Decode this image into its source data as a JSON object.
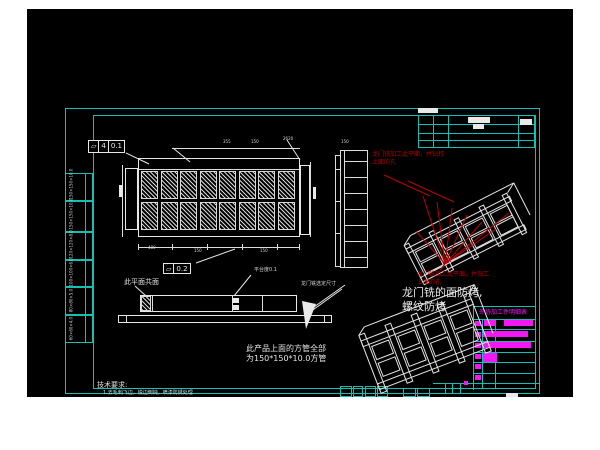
{
  "colors": {
    "bg": "#ffffff",
    "viewport": "#000000",
    "frame": "#14c0b4",
    "line": "#e9e9e9",
    "red": "#b40000",
    "magenta": "#f318f3"
  },
  "notes": {
    "red_top_1": "龙门铣加工此平面，并钻打",
    "red_top_2": "上面的孔",
    "red_bottom_1": "龙门铣加工此平面，并加工",
    "red_bottom_2": "上面的孔",
    "bake_1": "龙门铣的面防烤,",
    "bake_2": "螺纹防烤",
    "tube_1": "此产品上面的方管全部",
    "tube_2": "为150*150*10.0方管",
    "coplanar": "此平面共面",
    "platform": "平台度0.1",
    "gantry_dim": "龙门铣选定尺寸",
    "tech_title": "技术要求:",
    "tech_item": "1.去毛刺飞边，锐边倒钝，喷漆防锈处理"
  },
  "fcf1": {
    "sym": "▱",
    "n": "4",
    "val": "0.1"
  },
  "fcf2": {
    "sym": "▱",
    "val": "0.2"
  },
  "bom": {
    "header": "外协加工件明细表",
    "origin": [
      446,
      297
    ],
    "rows": [
      [
        [
          2,
          15,
          6,
          5
        ],
        [
          11,
          14,
          12,
          6
        ],
        [
          31,
          14,
          29,
          6
        ]
      ],
      [
        [
          2,
          26,
          6,
          5
        ],
        [
          10,
          25,
          45,
          6
        ]
      ],
      [
        [
          2,
          37,
          6,
          5
        ],
        [
          10,
          36,
          48,
          6
        ]
      ],
      [
        [
          2,
          48,
          6,
          5
        ],
        [
          10,
          47,
          14,
          9
        ]
      ],
      [
        [
          2,
          58,
          6,
          5
        ]
      ],
      [
        [
          2,
          69,
          6,
          5
        ]
      ]
    ]
  },
  "left_strip": {
    "ys": [
      164,
      192,
      223,
      251,
      278,
      306,
      334
    ],
    "cells": [
      "150×150×10.0",
      "150×150×10.0",
      "120×120×8.0",
      "100×100×6.0",
      "80×80×5.0",
      "60×60×4.0"
    ]
  },
  "top_view_grid": {
    "x": 114,
    "y": 162,
    "cols": 8,
    "rows": 2,
    "cellw": 17,
    "cellh": 28,
    "stepx": 19.5,
    "stepy": 31
  },
  "dims": [
    {
      "x": 196,
      "y": 131,
      "t": "355"
    },
    {
      "x": 224,
      "y": 131,
      "t": "150"
    },
    {
      "x": 256,
      "y": 128,
      "t": "2620"
    },
    {
      "x": 121,
      "y": 237,
      "t": "480"
    },
    {
      "x": 167,
      "y": 240,
      "t": "150"
    },
    {
      "x": 233,
      "y": 240,
      "t": "150"
    },
    {
      "x": 314,
      "y": 131,
      "t": "150"
    }
  ],
  "geometry": {
    "cyan_lines": [
      [
        391,
        106,
        1,
        32
      ],
      [
        406,
        106,
        1,
        32
      ],
      [
        421,
        106,
        1,
        32
      ],
      [
        491,
        106,
        1,
        32
      ],
      [
        507,
        106,
        1,
        32
      ],
      [
        391,
        115,
        118,
        1
      ],
      [
        391,
        124,
        118,
        1
      ],
      [
        391,
        131,
        118,
        1
      ],
      [
        391,
        138,
        118,
        1
      ],
      [
        446,
        297,
        1,
        84
      ],
      [
        455,
        310,
        1,
        70
      ],
      [
        468,
        310,
        1,
        70
      ],
      [
        446,
        297,
        63,
        1
      ],
      [
        446,
        310,
        63,
        1
      ],
      [
        446,
        320,
        63,
        1
      ],
      [
        446,
        332,
        63,
        1
      ],
      [
        446,
        343,
        63,
        1
      ],
      [
        446,
        353,
        63,
        1
      ],
      [
        446,
        364,
        63,
        1
      ],
      [
        446,
        374,
        63,
        1
      ],
      [
        406,
        374,
        107,
        1
      ],
      [
        418,
        374,
        1,
        11
      ],
      [
        425,
        374,
        1,
        11
      ],
      [
        433,
        374,
        1,
        11
      ]
    ],
    "cyan_cells": [
      [
        313,
        377,
        12,
        11
      ],
      [
        326,
        377,
        10,
        11
      ],
      [
        338,
        377,
        11,
        11
      ],
      [
        350,
        377,
        11,
        11
      ],
      [
        376,
        379,
        13,
        9
      ],
      [
        390,
        379,
        13,
        9
      ]
    ],
    "white_rects": [
      [
        111,
        149,
        162,
        79
      ],
      [
        98,
        159,
        13,
        62
      ],
      [
        273,
        156,
        10,
        70
      ],
      [
        113,
        286,
        157,
        17
      ],
      [
        91,
        306,
        214,
        8
      ]
    ],
    "white_lines": [
      [
        111,
        160,
        162,
        1
      ],
      [
        111,
        238,
        162,
        1
      ],
      [
        111,
        235,
        1,
        6
      ],
      [
        145,
        235,
        1,
        6
      ],
      [
        180,
        235,
        1,
        6
      ],
      [
        215,
        235,
        1,
        6
      ],
      [
        250,
        235,
        1,
        6
      ],
      [
        272,
        235,
        1,
        6
      ],
      [
        145,
        139,
        128,
        1
      ],
      [
        95,
        156,
        1,
        72
      ],
      [
        283,
        153,
        1,
        75
      ],
      [
        125,
        286,
        1,
        17
      ],
      [
        205,
        286,
        1,
        17
      ],
      [
        235,
        286,
        1,
        17
      ],
      [
        99,
        306,
        1,
        8
      ],
      [
        297,
        306,
        1,
        8
      ],
      [
        308,
        146,
        1,
        112
      ],
      [
        313,
        141,
        1,
        117
      ],
      [
        317,
        141,
        1,
        117
      ],
      [
        340,
        141,
        1,
        117
      ],
      [
        313,
        141,
        28,
        1
      ],
      [
        313,
        258,
        28,
        1
      ],
      [
        308,
        146,
        6,
        1
      ],
      [
        308,
        257,
        6,
        1
      ],
      [
        317,
        152,
        23,
        1
      ],
      [
        317,
        168,
        23,
        1
      ],
      [
        317,
        184,
        23,
        1
      ],
      [
        317,
        200,
        23,
        1
      ],
      [
        317,
        216,
        23,
        1
      ],
      [
        317,
        232,
        23,
        1
      ],
      [
        317,
        248,
        23,
        1
      ],
      [
        308,
        160,
        6,
        1
      ],
      [
        308,
        192,
        6,
        1
      ],
      [
        308,
        224,
        6,
        1
      ]
    ],
    "white_blocks": [
      [
        391,
        99,
        20,
        5
      ],
      [
        441,
        108,
        22,
        6
      ],
      [
        446,
        115,
        11,
        5
      ],
      [
        493,
        110,
        12,
        6
      ],
      [
        286,
        178,
        3,
        12
      ],
      [
        92,
        176,
        3,
        12
      ],
      [
        205,
        289,
        7,
        5
      ],
      [
        205,
        296,
        7,
        5
      ],
      [
        479,
        384,
        12,
        4
      ]
    ],
    "magenta_blocks": [
      [
        437,
        372,
        4,
        4
      ]
    ],
    "hatch_extra": [
      [
        114,
        287,
        10,
        15
      ]
    ]
  }
}
